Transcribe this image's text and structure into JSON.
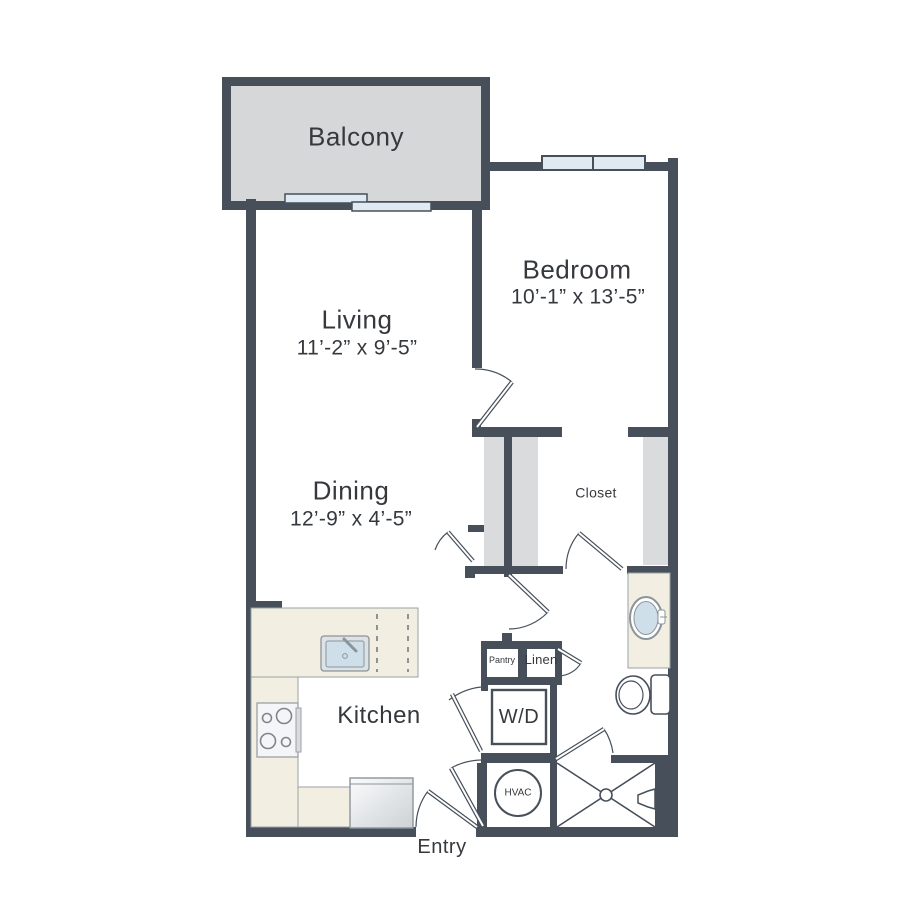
{
  "colors": {
    "wall": "#47505a",
    "balcony_fill": "#d5d7d9",
    "closet_fill": "#dadbdd",
    "counter_fill": "#f2efe2",
    "window_fill": "#dfeaf2",
    "sink_fill": "#cfdfe9",
    "fixture_stroke": "#8b949b",
    "label_color": "#35393d"
  },
  "rooms": {
    "balcony": {
      "label": "Balcony"
    },
    "bedroom": {
      "label": "Bedroom",
      "dimensions": "10’-1” x 13’-5”"
    },
    "living": {
      "label": "Living",
      "dimensions": "11’-2” x 9’-5”"
    },
    "dining": {
      "label": "Dining",
      "dimensions": "12’-9” x 4’-5”"
    },
    "closet": {
      "label": "Closet"
    },
    "kitchen": {
      "label": "Kitchen"
    },
    "pantry": {
      "label": "Pantry"
    },
    "linen": {
      "label": "Linen"
    },
    "washer_dryer": {
      "label": "W/D"
    },
    "hvac": {
      "label": "HVAC"
    },
    "entry": {
      "label": "Entry"
    }
  }
}
